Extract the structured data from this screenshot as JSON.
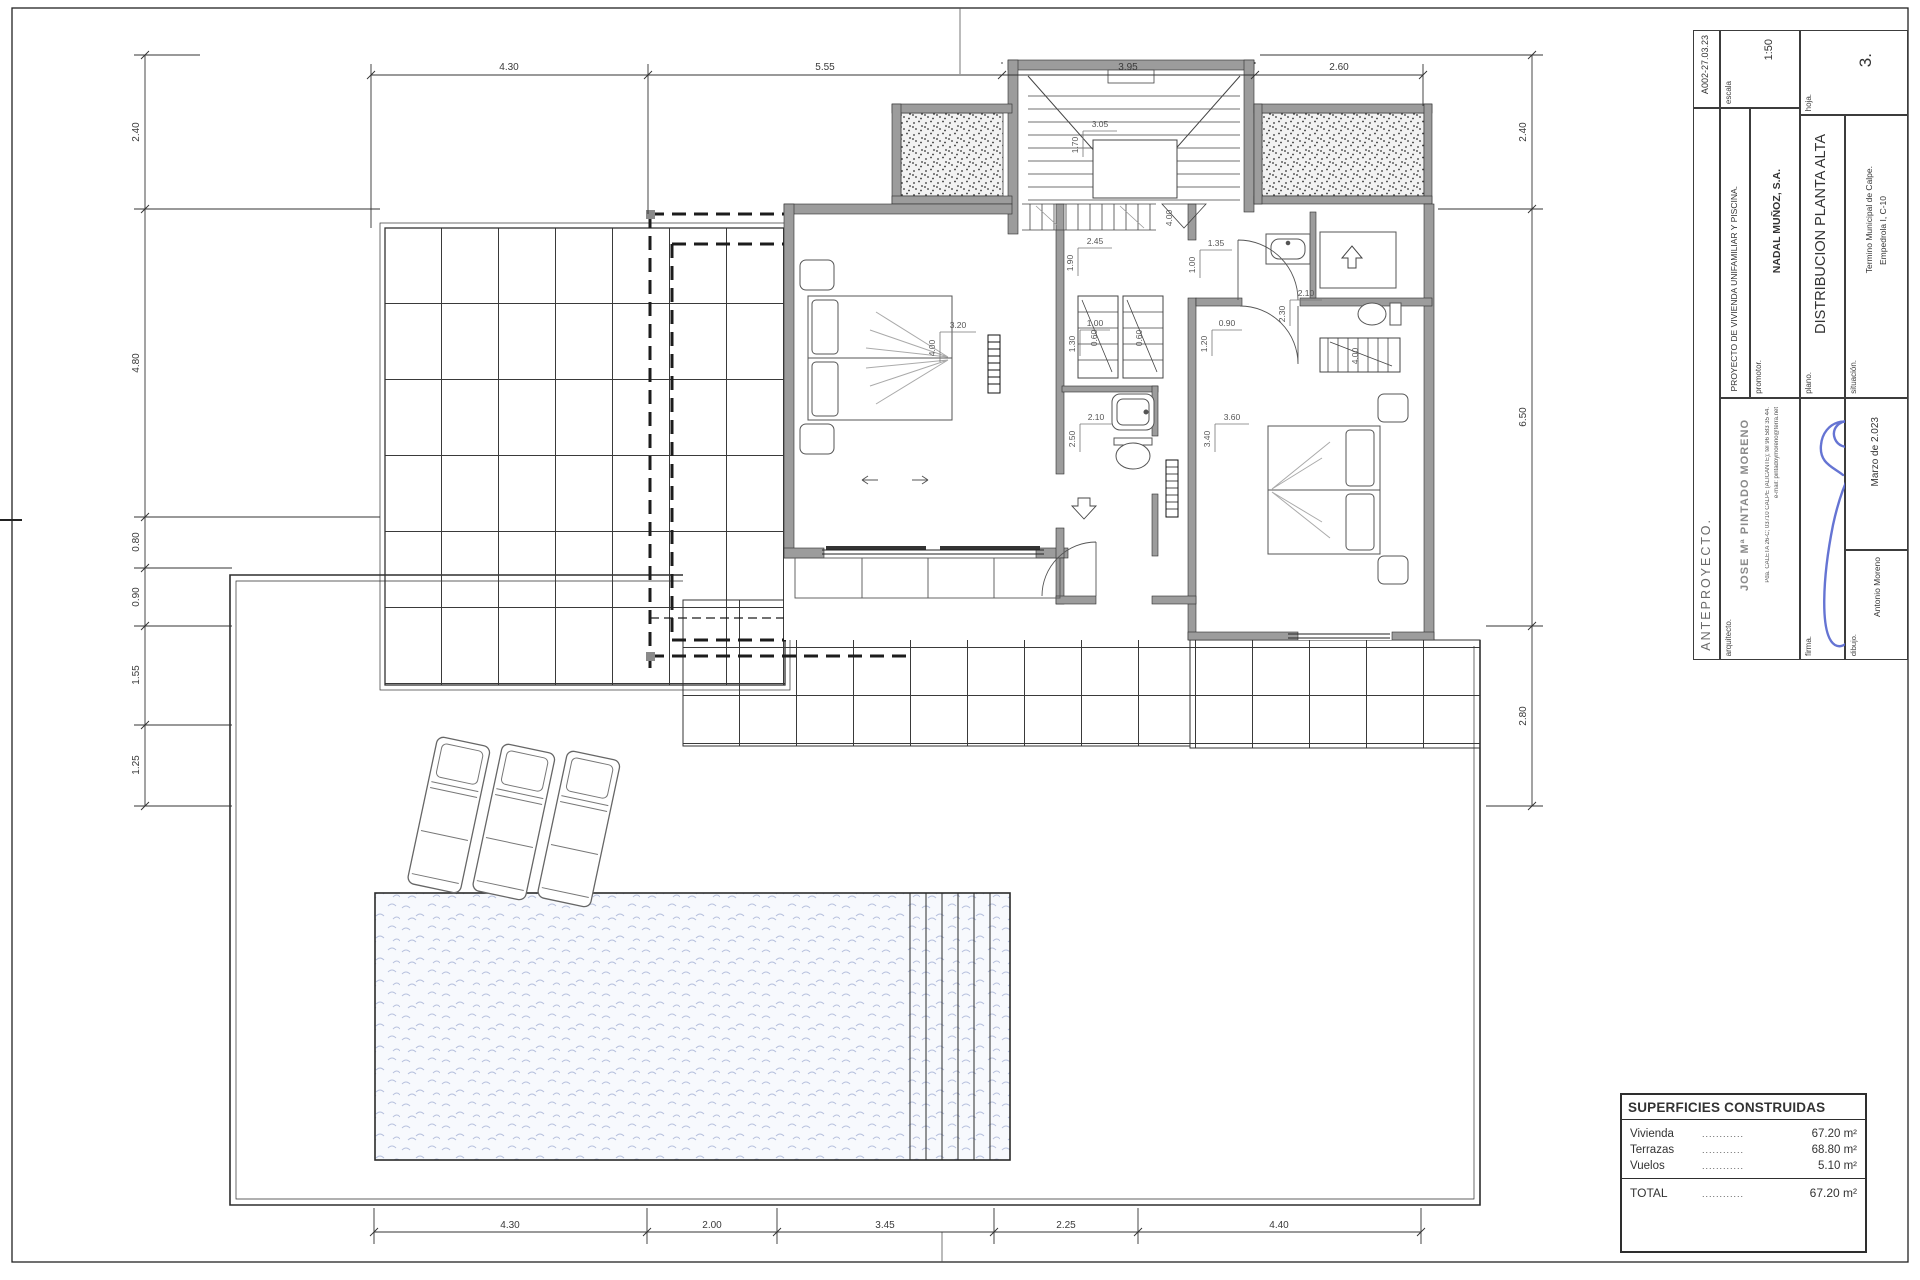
{
  "title_block": {
    "ref": "A002-27.03.23",
    "escala_label": "escala",
    "escala": "1:50",
    "hoja_label": "hoja.",
    "hoja": "3.",
    "proyecto": "PROYECTO DE VIVIENDA UNIFAMILIAR Y PISCINA.",
    "promotor_label": "promotor.",
    "promotor": "NADAL MUÑOZ, S.A.",
    "plano_label": "plano.",
    "plano": "DISTRIBUCION PLANTA ALTA",
    "situacion_label": "situación.",
    "situacion_1": "Termino Municipal de Calpe.",
    "situacion_2": "Empedrola I, C-10",
    "anteproyecto": "ANTEPROYECTO.",
    "arquitecto_label": "arquitecto.",
    "arquitecto": "JOSE Mª PINTADO MORENO",
    "direccion": "Pda. CALETA 26-C; 03710 CALPE (ALICANTE); tel 96 583 35 44.",
    "email": "e-mail: pintadoymoreno@terra.net",
    "firma_label": "firma.",
    "fecha": "Marzo de 2.023",
    "dibujo_label": "dibujo.",
    "dibujo": "Antonio Moreno"
  },
  "surfaces": {
    "title": "SUPERFICIES CONSTRUIDAS",
    "rows": [
      {
        "label": "Vivienda",
        "dots": "............",
        "value": "67.20 m²"
      },
      {
        "label": "Terrazas",
        "dots": "............",
        "value": "68.80 m²"
      },
      {
        "label": "Vuelos",
        "dots": "............",
        "value": "5.10 m²"
      }
    ],
    "total": {
      "label": "TOTAL",
      "dots": "............",
      "value": "67.20 m²"
    }
  },
  "dims": {
    "top": [
      "4.30",
      "5.55",
      "3.95",
      "2.60"
    ],
    "bottom": [
      "4.30",
      "2.00",
      "3.45",
      "2.25",
      "4.40"
    ],
    "left": [
      "2.40",
      "4.80",
      "0.80",
      "0.90",
      "1.55",
      "1.25"
    ],
    "right": [
      "2.40",
      "6.50",
      "2.80"
    ]
  },
  "interior": {
    "stair_w": "3.05",
    "stair_h": "1.70",
    "landing_w": "2.45",
    "landing_h": "1.90",
    "hall_w": "1.35",
    "hall_h": "1.00",
    "bed1_w": "3.20",
    "bed1_h": "4.00",
    "closet1": "0.60",
    "closet2": "0.60",
    "pass_w": "1.00",
    "pass_h": "1.30",
    "pass2_w": "0.90",
    "pass2_h": "1.20",
    "bath1_w": "2.10",
    "bath1_h": "2.50",
    "bath2_w": "2.10",
    "bath2_h": "2.30",
    "bed2_w": "3.60",
    "bed2_h": "3.40",
    "rail_len": "4.00",
    "closet3_len": "4.00"
  },
  "colors": {
    "wall": "#9c9c9c",
    "line": "#2e2e2e",
    "water": "#b7c1de",
    "signature": "#5868cf"
  }
}
